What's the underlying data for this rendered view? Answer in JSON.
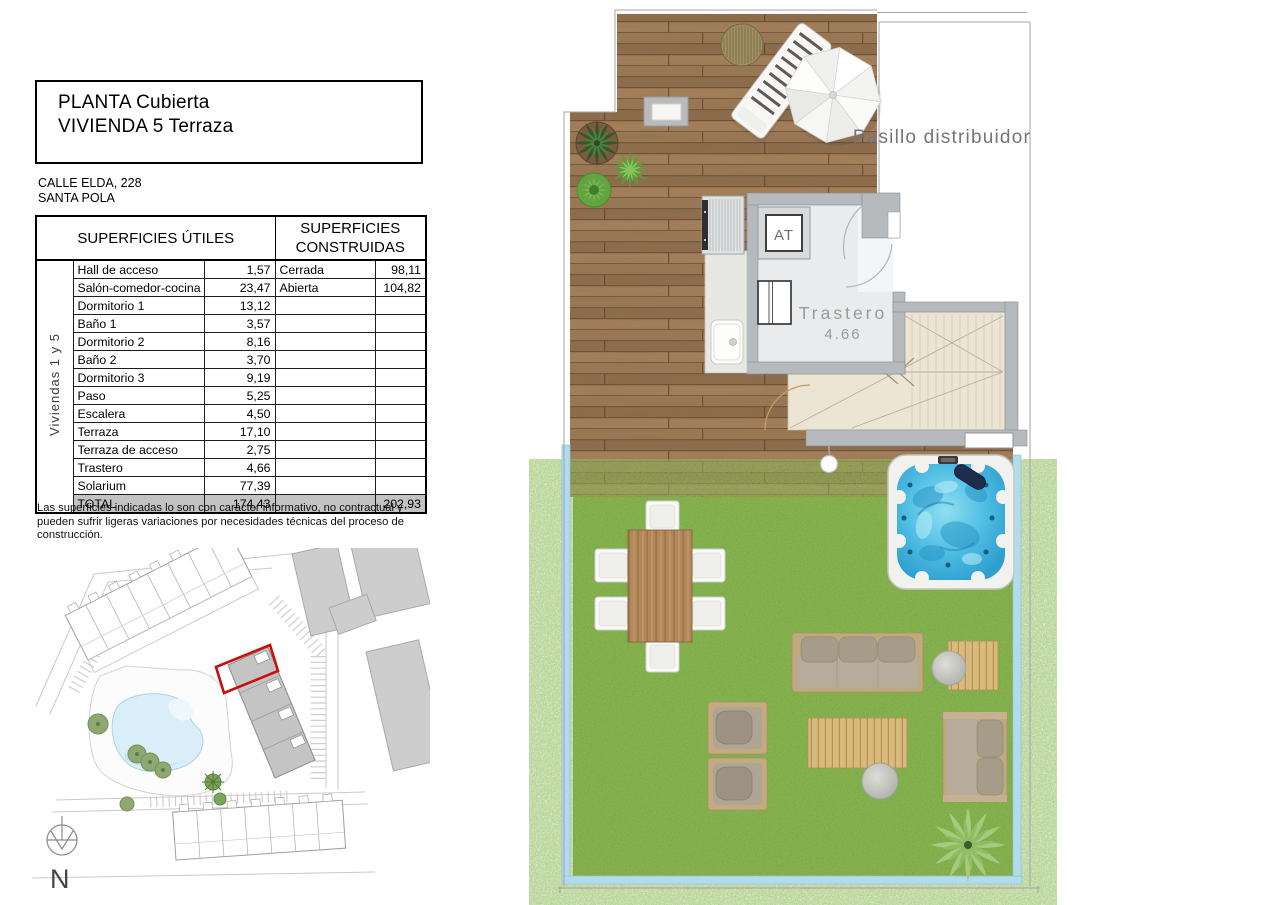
{
  "header": {
    "title_line1": "PLANTA Cubierta",
    "title_line2": "VIVIENDA 5 Terraza",
    "address_line1": "CALLE ELDA, 228",
    "address_line2": "SANTA POLA"
  },
  "surfaces_table": {
    "header_utiles": "SUPERFICIES ÚTILES",
    "header_construidas": "SUPERFICIES CONSTRUIDAS",
    "group_label": "Viviendas 1 y 5",
    "rows": [
      {
        "label": "Hall de acceso",
        "util": "1,57",
        "c_label": "Cerrada",
        "c_value": "98,11"
      },
      {
        "label": "Salón-comedor-cocina",
        "util": "23,47",
        "c_label": "Abierta",
        "c_value": "104,82"
      },
      {
        "label": "Dormitorio 1",
        "util": "13,12",
        "c_label": "",
        "c_value": ""
      },
      {
        "label": "Baño 1",
        "util": "3,57",
        "c_label": "",
        "c_value": ""
      },
      {
        "label": "Dormitorio 2",
        "util": "8,16",
        "c_label": "",
        "c_value": ""
      },
      {
        "label": "Baño 2",
        "util": "3,70",
        "c_label": "",
        "c_value": ""
      },
      {
        "label": "Dormitorio 3",
        "util": "9,19",
        "c_label": "",
        "c_value": ""
      },
      {
        "label": "Paso",
        "util": "5,25",
        "c_label": "",
        "c_value": ""
      },
      {
        "label": "Escalera",
        "util": "4,50",
        "c_label": "",
        "c_value": ""
      },
      {
        "label": "Terraza",
        "util": "17,10",
        "c_label": "",
        "c_value": ""
      },
      {
        "label": "Terraza de acceso",
        "util": "2,75",
        "c_label": "",
        "c_value": ""
      },
      {
        "label": "Trastero",
        "util": "4,66",
        "c_label": "",
        "c_value": ""
      },
      {
        "label": "Solarium",
        "util": "77,39",
        "c_label": "",
        "c_value": ""
      }
    ],
    "total": {
      "label": "TOTAL",
      "util": "174,43",
      "c_label": "",
      "c_value": "202,93"
    }
  },
  "disclaimer": "Las superficies indicadas lo son con carácter informativo, no contractual y pueden sufrir ligeras variaciones por necesidades técnicas del proceso de construcción.",
  "floor_plan": {
    "corridor_label": "Pasillo distribuidor",
    "storage_label": "Trastero",
    "storage_area": "4.66",
    "at_label": "AT"
  },
  "site_plan": {
    "north_label": "N"
  },
  "colors": {
    "highlight_red": "#c80f0f",
    "deck_wood": "#9c7a57",
    "grass": "#74a23c",
    "water": "#35aeda",
    "balustrade": "#b2dceb",
    "wall_gray": "#b6babd",
    "stair_beige": "#ece5d3",
    "total_row_gray": "#c3c3c3"
  }
}
